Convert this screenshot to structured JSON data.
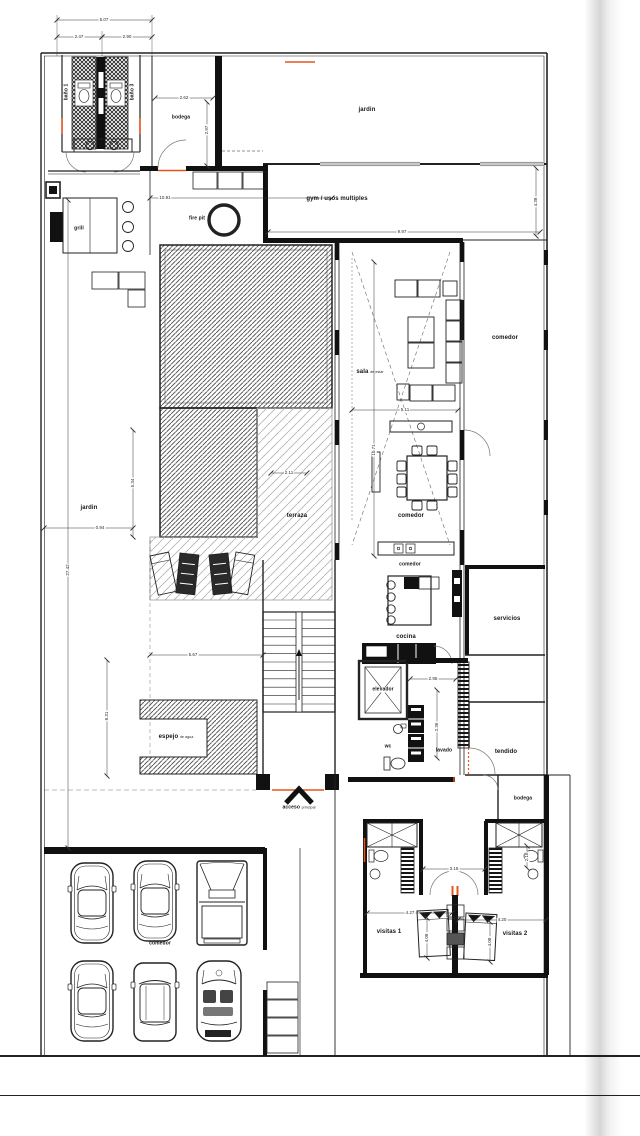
{
  "title": "planta arquitectónica",
  "colors": {
    "line": "#222222",
    "wall": "#111111",
    "accent": "#e8551c",
    "pool_hatch": "#4a4a4a",
    "deck_hatch": "#b5b5b5",
    "paper_shadow": "#c9c9c9"
  },
  "labels": {
    "banio1": "baño 1",
    "banio3": "baño 3",
    "bodega_top": "bodega",
    "jardin_top": "jardin",
    "gym": "gym / usos multiples",
    "grill": "grill",
    "fire_pit": "fire pit",
    "sala_main": "sala",
    "sala_sub": "de estar",
    "comedor_right": "comedor",
    "comedor_dining": "comedor",
    "comedor_bar": "comedor",
    "cocina": "cocina",
    "servicios": "servicios",
    "jardin_left": "jardin",
    "terraza": "terraza",
    "elevador": "elevador",
    "wc": "wc",
    "lavado": "lavado",
    "tendido": "tendido",
    "espejo_main": "espejo",
    "espejo_sub": "de agua",
    "acceso_main": "acceso",
    "acceso_sub": "principal",
    "bodega_lower": "bodega",
    "visitas1": "visitas 1",
    "visitas2": "visitas 2",
    "garage": "comedor"
  },
  "dims": {
    "top_total": "5.07",
    "top_a": "2.47",
    "top_b": "2.90",
    "bodega_w": "2.62",
    "bodega_h": "2.97",
    "terrace_len": "10.91",
    "gym_w": "9.97",
    "gym_h": "4.38",
    "sala_w": "5.11",
    "sala_h": "10.71",
    "deck_w": "2.11",
    "pool_h": "5.34",
    "jardin_w": "0.94",
    "site_h": "27.42",
    "stair_w": "5.67",
    "court_h": "8.31",
    "hall_w": "2.95",
    "hall_h": "2.36",
    "bath_gap": "3.15",
    "closet_d": "2.10",
    "visitas1_w": "4.27",
    "visitas2_w": "4.20",
    "visitas1_h": "4.08",
    "visitas2_h": "4.08"
  }
}
